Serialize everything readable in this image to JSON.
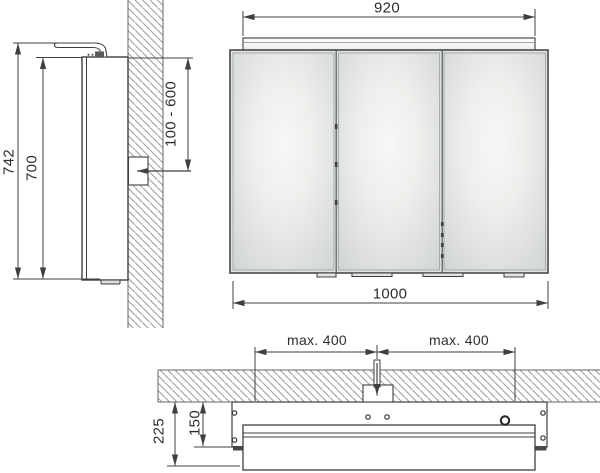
{
  "drawing": {
    "front_view": {
      "light_width_mm": "920",
      "total_width_mm": "1000"
    },
    "side_view": {
      "total_height_mm": "742",
      "body_height_mm": "700",
      "outlet_height_range_mm": "100 - 600"
    },
    "plan_view": {
      "outlet_offset_left": "max. 400",
      "outlet_offset_right": "max. 400",
      "total_depth_mm": "225",
      "body_depth_mm": "150"
    }
  },
  "colors": {
    "line": "#3f3f3f",
    "hatch": "#9b9b9b",
    "mirror_edge": "#d1d5d4",
    "mirror_center": "#f7f7f5"
  }
}
